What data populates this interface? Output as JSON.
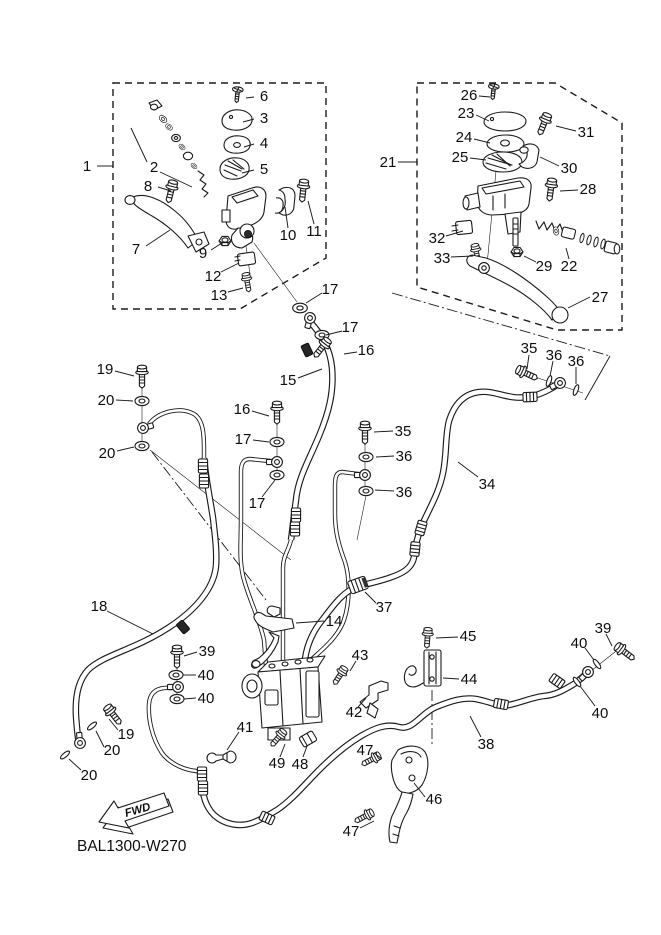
{
  "figure": {
    "drawing_code": "BAL1300-W270",
    "direction_label": "FWD"
  },
  "callouts": [
    "1",
    "2",
    "3",
    "4",
    "5",
    "6",
    "7",
    "8",
    "9",
    "10",
    "11",
    "12",
    "13",
    "17",
    "21",
    "22",
    "23",
    "24",
    "25",
    "26",
    "27",
    "28",
    "29",
    "30",
    "31",
    "32",
    "33",
    "17",
    "16",
    "15",
    "19",
    "20",
    "20",
    "16",
    "17",
    "17",
    "35",
    "36",
    "36",
    "35",
    "36",
    "36",
    "34",
    "37",
    "14",
    "18",
    "39",
    "40",
    "40",
    "43",
    "42",
    "41",
    "49",
    "48",
    "47",
    "46",
    "47",
    "45",
    "44",
    "38",
    "39",
    "40",
    "40",
    "19",
    "20",
    "20"
  ]
}
